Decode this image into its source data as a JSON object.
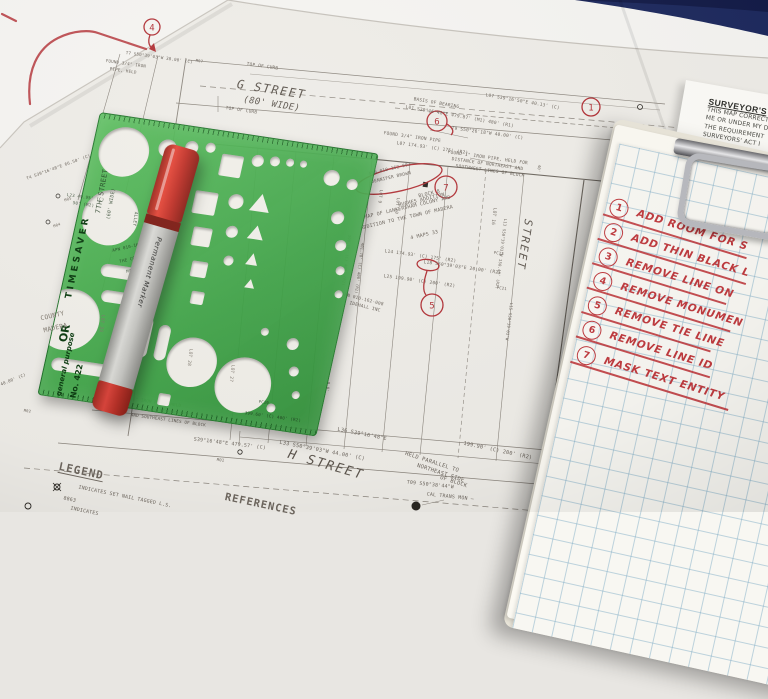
{
  "colors": {
    "desk_blue": "#1e2a5e",
    "template_green": "#4db153",
    "ink_red": "#b5353a",
    "checklist_red": "#bf3a3e",
    "grid_blue": "#80adc6",
    "paper": "#eeece7"
  },
  "surveyor_note": {
    "title": "SURVEYOR'S",
    "line1": "THIS MAP CORRECT",
    "line2": "ME OR UNDER MY D",
    "line3": "THE REQUIREMENT",
    "line4": "SURVEYORS' ACT I",
    "signature": "ALEX ALDER, P.L."
  },
  "checklist": {
    "items": [
      {
        "num": "1",
        "text": "ADD ROOM FOR S"
      },
      {
        "num": "2",
        "text": "ADD THIN BLACK L"
      },
      {
        "num": "3",
        "text": "REMOVE LINE ON"
      },
      {
        "num": "4",
        "text": "REMOVE MONUMEN"
      },
      {
        "num": "5",
        "text": "REMOVE TIE LINE"
      },
      {
        "num": "6",
        "text": "REMOVE LINE ID"
      },
      {
        "num": "7",
        "text": "MASK TEXT ENTITY"
      }
    ]
  },
  "stencil": {
    "brand": "TIMESAVER",
    "mark": "OR",
    "type": "general purpose",
    "model": "No. 422"
  },
  "marker": {
    "label": "Permanent Marker"
  },
  "map": {
    "callouts": {
      "c1": "1",
      "c4": "4",
      "c5": "5",
      "c6": "6",
      "c7": "7"
    },
    "labels": {
      "g_street": "G STREET",
      "g_width": "(80' WIDE)",
      "top_of_curb": "TOP OF CURB",
      "basis1": "BASIS OF BEARING",
      "basis2": "L01 S39°16'48\"E  479.87' (M1) 480' (R1)",
      "l07a": "L07 S39°16'50\"E  40.13' (C)",
      "t9": "T9 S50°26'18\"W  40.00' (C)",
      "found34": "FOUND 3/4\" IRON PIPE",
      "l07b": "L07 174.93' (C) 175' (R2)",
      "found1a": "FOUND 1\" IRON PIPE, HELD FOR",
      "found1b": "DISTANCE OF NORTHEAST AND",
      "found1c": "SOUTHWEST LINES OF BLOCK",
      "apn2": "APN 010-162-002",
      "apn2_owner": "JENNIFER BROWN",
      "block1": "BLOCK 8",
      "block2": "HUGHES ADDITION",
      "block3": "MAP OF LANKERSHAM COLONY AND",
      "block4": "ADDITION TO THE TOWN OF MADERA",
      "block5": "4 MAPS 33",
      "l14": "L14 174.93' (C) 175' (R2)",
      "l18": "L18 S50°39'03\"E  20.00' (R2)",
      "l25": "L25 199.90' (C) 200' (R2)",
      "apn8": "APN 010-162-008",
      "apn8_owner": "IDEHALL INC",
      "lot16": "LOT 16",
      "l13": "L13 S50°39'03\"W  150.48' (R2)",
      "street_right": "STREET",
      "l15": "L15 S50°39'03\"W",
      "pc23": "PC23",
      "pc21": "PC21",
      "pc19": "PC19",
      "d40": "40'",
      "d8": "8.0'",
      "lot9": "LOT 9",
      "lot10": "LOT 10",
      "d398": "398.78' (C) 400' (R2)",
      "d401": "401.78' (C) 400' (R2)",
      "l36a": "L36 S39°16'48\"E",
      "l36b": "199.90' (C) 200' (R2)",
      "l33": "L33 S50°39'03\"W  44.00' (C)",
      "h_street": "H STREET",
      "held1": "HELD PARALLEL TO",
      "held2": "NORTHEAST SIDE",
      "held3": "OF BLOCK",
      "t09": "T09 S50°38'44\"W",
      "l35": "S39°16'48\"E  479.57' (C)",
      "m01": "M01",
      "caltrans": "CAL TRANS MON —",
      "legend_title": "LEGEND",
      "legend1a": "INDICATES SET NAIL TAGGED L.S.",
      "legend1b": "8863",
      "legend2": "INDICATES",
      "references_title": "REFERENCES",
      "t4": "T4 S39°16'48\"E  66.50' (C)",
      "m05": "M05",
      "m04": "M04",
      "m02": "M02",
      "m07": "M07",
      "d4400": "40.00' (C)",
      "t7": "T7 S50°39'03\"W  38.00' (C)",
      "f34b": "FOUND 3/4\" IRON",
      "f34c": "PIPE, HELD",
      "f2a": "FOUND 1\" IRON PIPE, HELD",
      "f2b": "FOR POSITION OF NORTHWEST",
      "f2c": "AND SOUTHEAST LINES OF BLOCK",
      "street7": "7TH STREET",
      "street7w": "(60' WIDE)",
      "thru_county1": "COUNTY",
      "thru_county2": "MADERA",
      "thru_lot27": "LOT 27",
      "thru_lot28": "LOT 28",
      "thru_lot33": "LOT 33",
      "thru_apn12": "APN 010-162-012",
      "thru_apn12b": "THE COLONY OF",
      "thru_apn12c": "MADERA",
      "thru_l23a": "L23 49.95' (C)",
      "thru_l23b": "50' (R2)",
      "thru_alley": "ALLEY",
      "d399": "399.60' (C) 400' (R2)"
    }
  }
}
